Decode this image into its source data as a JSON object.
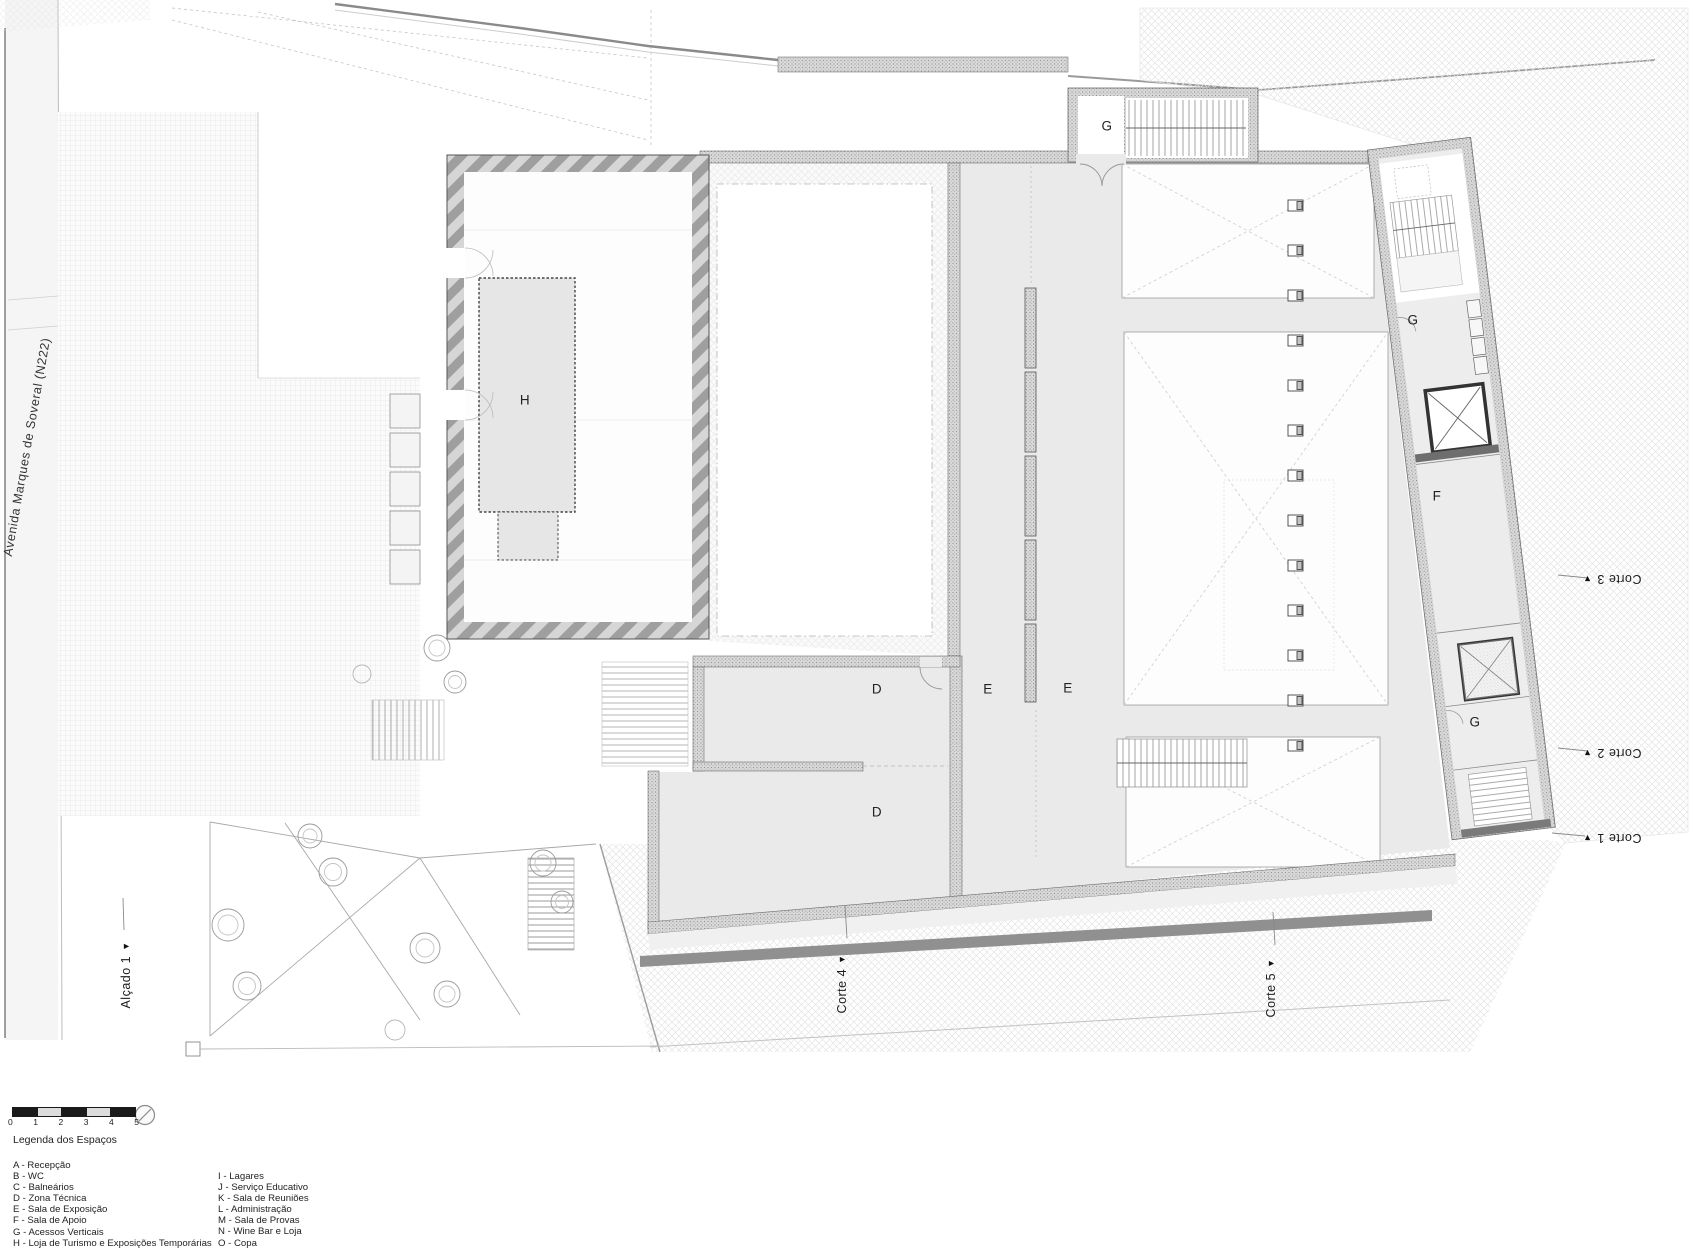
{
  "plan": {
    "street_label": "Avenida Marques de Soveral (N222)",
    "rooms": {
      "g_top": "G",
      "h": "H",
      "d_upper": "D",
      "d_lower": "D",
      "e_left": "E",
      "e_right": "E",
      "g_wing_upper": "G",
      "f_wing": "F",
      "g_wing_lower": "G"
    },
    "sections": {
      "corte_1": "Corte 1",
      "corte_2": "Corte 2",
      "corte_3": "Corte 3",
      "corte_4": "Corte 4",
      "corte_5": "Corte 5",
      "alcado_1": "Alçado 1"
    },
    "icons": {
      "section_arrow": "▼"
    },
    "scale_bar": {
      "ticks": [
        "0",
        "1",
        "2",
        "3",
        "4",
        "5"
      ]
    },
    "legend": {
      "title": "Legenda dos Espaços",
      "column_1": [
        "A - Recepção",
        "B - WC",
        "C - Balneários",
        "D - Zona Técnica",
        "E - Sala de Exposição",
        "F - Sala de Apoio",
        "G - Acessos Verticais",
        "H - Loja de Turismo e Exposições Temporárias"
      ],
      "column_2": [
        "I - Lagares",
        "J - Serviço Educativo",
        "K - Sala de Reuniões",
        "L - Administração",
        "M - Sala de Provas",
        "N - Wine Bar e Loja",
        "O - Copa"
      ]
    }
  }
}
